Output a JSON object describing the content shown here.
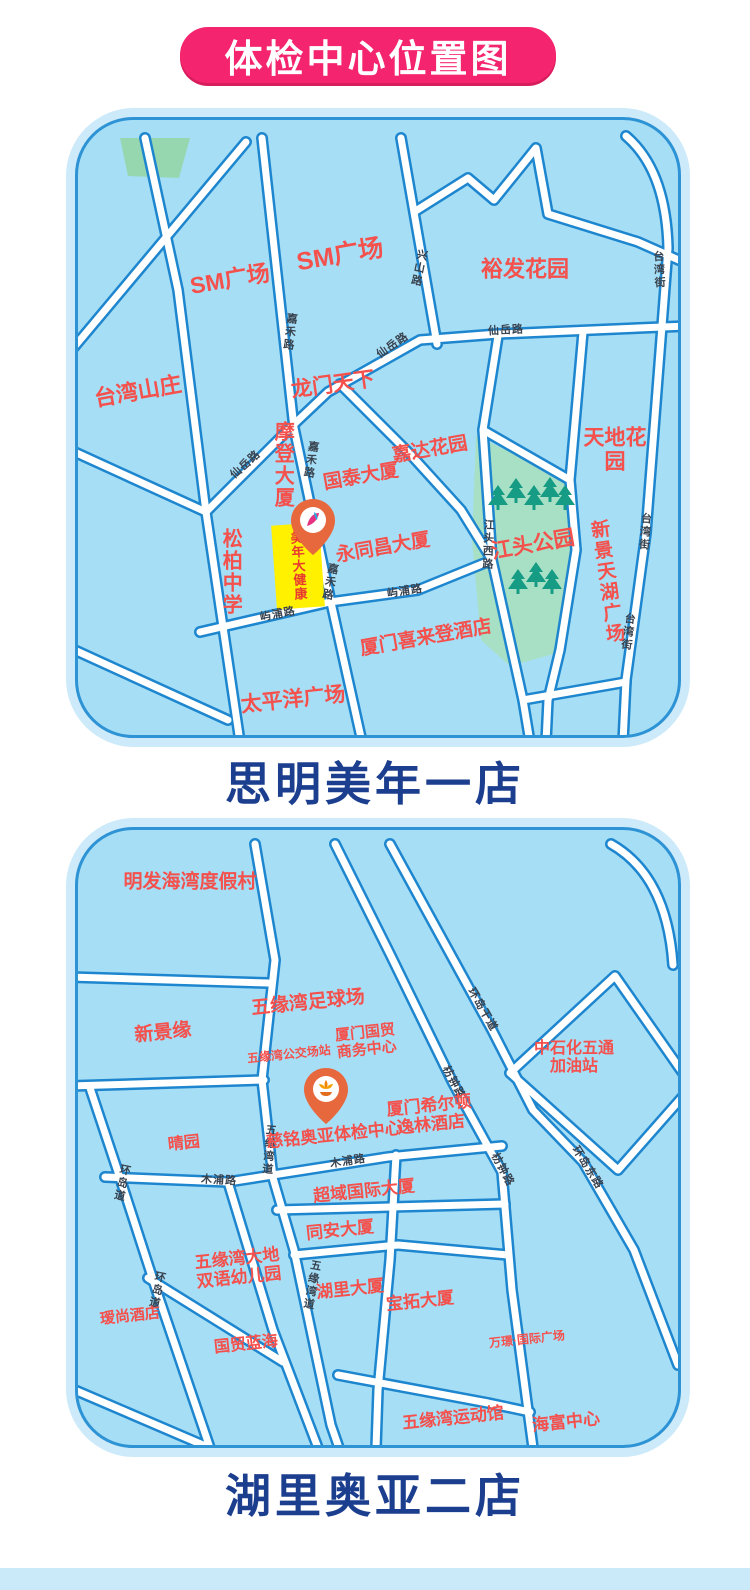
{
  "banner": {
    "title": "体检中心位置图"
  },
  "colors": {
    "banner_bg": "#F4246E",
    "banner_text": "#FFFFFF",
    "caption_text": "#1B3E8E",
    "map_bg": "#A6DEF6",
    "map_rim": "#CCEAF9",
    "map_border": "#2E93D5",
    "road_casing": "#1D86CE",
    "road_fill": "#FFFFFF",
    "place_label": "#F4504C",
    "road_label": "#39434F",
    "park_green": "#A8E0C5",
    "tree_green": "#169B84",
    "landmark_yellow": "#FFF100",
    "landmark_text": "#E83A30",
    "pin_orange": "#E8683E",
    "footer_strip": "#CBEAF9"
  },
  "maps": [
    {
      "caption": "思明美年一店",
      "landmark": {
        "label": "美年大健康"
      },
      "pin": {
        "x": 235,
        "y": 436,
        "logo": "meinian-logo"
      },
      "places": [
        {
          "text": "SM广场",
          "x": 152,
          "y": 160,
          "rot": -10,
          "size": 23
        },
        {
          "text": "SM广场",
          "x": 262,
          "y": 135,
          "rot": -10,
          "size": 25
        },
        {
          "text": "裕发花园",
          "x": 447,
          "y": 150,
          "rot": 0,
          "size": 22
        },
        {
          "text": "台湾山庄",
          "x": 60,
          "y": 272,
          "rot": -10,
          "size": 22
        },
        {
          "text": "龙门天下",
          "x": 255,
          "y": 265,
          "rot": -8,
          "size": 21
        },
        {
          "text": "摩登大厦",
          "x": 204,
          "y": 345,
          "vertical": true,
          "size": 20
        },
        {
          "text": "国泰大厦",
          "x": 283,
          "y": 357,
          "rot": -10,
          "size": 19
        },
        {
          "text": "嘉达花园",
          "x": 352,
          "y": 330,
          "rot": -10,
          "size": 19
        },
        {
          "text": "天地花园",
          "x": 537,
          "y": 330,
          "rot": 0,
          "size": 21
        },
        {
          "text": "松柏中学",
          "x": 152,
          "y": 452,
          "vertical": true,
          "size": 20
        },
        {
          "text": "永同昌大厦",
          "x": 305,
          "y": 428,
          "rot": -10,
          "size": 19
        },
        {
          "text": "江头公园",
          "x": 455,
          "y": 425,
          "rot": -10,
          "size": 21
        },
        {
          "text": "新景天湖广场",
          "x": 528,
          "y": 462,
          "vertical": true,
          "rot": -8,
          "size": 19
        },
        {
          "text": "厦门喜来登酒店",
          "x": 348,
          "y": 518,
          "rot": -10,
          "size": 19
        },
        {
          "text": "太平洋广场",
          "x": 215,
          "y": 580,
          "rot": -6,
          "size": 21
        }
      ],
      "road_labels": [
        {
          "text": "兴山路",
          "x": 340,
          "y": 148,
          "vertical": true,
          "rot": 12
        },
        {
          "text": "仙岳路",
          "x": 428,
          "y": 211,
          "rot": -3
        },
        {
          "text": "仙岳路",
          "x": 315,
          "y": 226,
          "rot": -35
        },
        {
          "text": "仙岳路",
          "x": 168,
          "y": 345,
          "rot": -42
        },
        {
          "text": "嘉禾路",
          "x": 211,
          "y": 212,
          "vertical": true,
          "rot": 7
        },
        {
          "text": "嘉禾路",
          "x": 232,
          "y": 340,
          "vertical": true,
          "rot": 9
        },
        {
          "text": "嘉禾路",
          "x": 251,
          "y": 462,
          "vertical": true,
          "rot": 11
        },
        {
          "text": "江头西路",
          "x": 409,
          "y": 425,
          "vertical": true,
          "rot": 2
        },
        {
          "text": "屿浦路",
          "x": 200,
          "y": 495,
          "rot": -11
        },
        {
          "text": "屿浦路",
          "x": 327,
          "y": 472,
          "rot": -9
        },
        {
          "text": "台湾街",
          "x": 580,
          "y": 150,
          "vertical": true,
          "rot": -3
        },
        {
          "text": "台湾街",
          "x": 566,
          "y": 412,
          "vertical": true,
          "rot": 4
        },
        {
          "text": "台湾街",
          "x": 549,
          "y": 512,
          "vertical": true,
          "rot": 7
        }
      ]
    },
    {
      "caption": "湖里奥亚二店",
      "pin": {
        "x": 248,
        "y": 295,
        "logo": "ciming-logo"
      },
      "places": [
        {
          "text": "明发海湾度假村",
          "x": 112,
          "y": 52,
          "rot": 0,
          "size": 19
        },
        {
          "text": "新景缘",
          "x": 85,
          "y": 203,
          "rot": -6,
          "size": 19
        },
        {
          "text": "五缘湾足球场",
          "x": 230,
          "y": 173,
          "rot": -6,
          "size": 19
        },
        {
          "text": "厦门国贸\n商务中心",
          "x": 288,
          "y": 212,
          "rot": -6,
          "size": 15
        },
        {
          "text": "五缘湾公交场站",
          "x": 211,
          "y": 225,
          "rot": -6,
          "size": 12
        },
        {
          "text": "中石化五通\n加油站",
          "x": 496,
          "y": 228,
          "rot": 0,
          "size": 16
        },
        {
          "text": "厦门希尔顿\n逸林酒店",
          "x": 352,
          "y": 285,
          "rot": -6,
          "size": 17
        },
        {
          "text": "慈铭奥亚体检中心",
          "x": 256,
          "y": 305,
          "rot": -6,
          "size": 17
        },
        {
          "text": "晴园",
          "x": 106,
          "y": 314,
          "rot": -6,
          "size": 16
        },
        {
          "text": "超域国际大厦",
          "x": 286,
          "y": 361,
          "rot": -6,
          "size": 17
        },
        {
          "text": "同安大厦",
          "x": 262,
          "y": 400,
          "rot": -6,
          "size": 17
        },
        {
          "text": "五缘湾大地\n双语幼儿园",
          "x": 160,
          "y": 438,
          "rot": -6,
          "size": 17
        },
        {
          "text": "湖里大厦",
          "x": 272,
          "y": 459,
          "rot": -6,
          "size": 17
        },
        {
          "text": "宝拓大厦",
          "x": 342,
          "y": 471,
          "rot": -6,
          "size": 17
        },
        {
          "text": "瑷尚酒店",
          "x": 52,
          "y": 487,
          "rot": -6,
          "size": 15
        },
        {
          "text": "国贸蓝海",
          "x": 168,
          "y": 515,
          "rot": -6,
          "size": 16
        },
        {
          "text": "万璟·国际广场",
          "x": 449,
          "y": 510,
          "rot": -6,
          "size": 12
        },
        {
          "text": "五缘湾运动馆",
          "x": 375,
          "y": 588,
          "rot": -6,
          "size": 17
        },
        {
          "text": "海富中心",
          "x": 488,
          "y": 592,
          "rot": -6,
          "size": 17
        }
      ],
      "road_labels": [
        {
          "text": "五缘湾道",
          "x": 190,
          "y": 320,
          "vertical": true,
          "rot": 5
        },
        {
          "text": "五缘湾道",
          "x": 233,
          "y": 455,
          "vertical": true,
          "rot": 10
        },
        {
          "text": "木浦路",
          "x": 270,
          "y": 332,
          "rot": -9
        },
        {
          "text": "木浦路",
          "x": 141,
          "y": 351,
          "rot": 3
        },
        {
          "text": "环岛干道",
          "x": 404,
          "y": 180,
          "rot": 60
        },
        {
          "text": "枋钟路",
          "x": 375,
          "y": 253,
          "rot": 62
        },
        {
          "text": "枋钟路",
          "x": 424,
          "y": 340,
          "rot": 62
        },
        {
          "text": "环岛东路",
          "x": 509,
          "y": 338,
          "rot": 58
        },
        {
          "text": "环岛道",
          "x": 43,
          "y": 353,
          "vertical": true,
          "rot": 12
        },
        {
          "text": "环岛道",
          "x": 78,
          "y": 460,
          "vertical": true,
          "rot": 12
        }
      ]
    }
  ]
}
